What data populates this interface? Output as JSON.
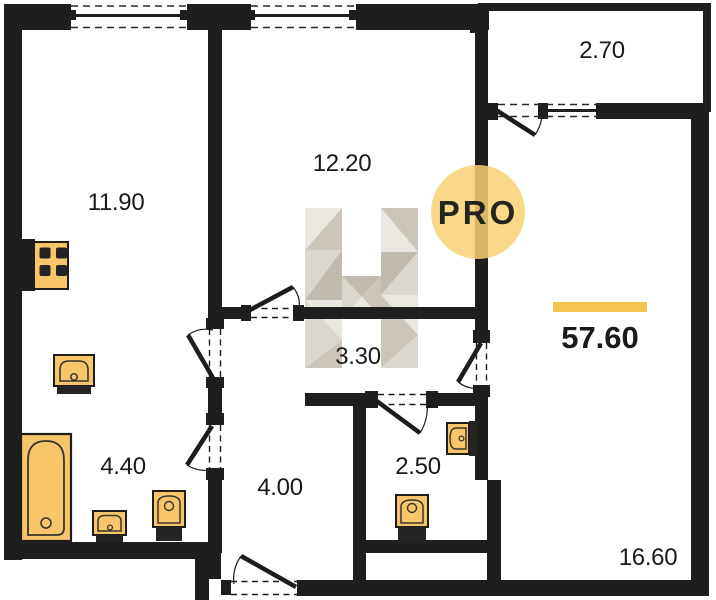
{
  "plan": {
    "type": "apartment-floor-plan",
    "total_area": "57.60",
    "rooms": [
      {
        "name": "room-left",
        "area": "11.90"
      },
      {
        "name": "room-middle",
        "area": "12.20"
      },
      {
        "name": "balcony",
        "area": "2.70"
      },
      {
        "name": "hallway",
        "area": "3.30"
      },
      {
        "name": "bathroom",
        "area": "4.40"
      },
      {
        "name": "hall",
        "area": "4.00"
      },
      {
        "name": "wc",
        "area": "2.50"
      },
      {
        "name": "room-right",
        "area": "16.60"
      }
    ],
    "watermark": {
      "badge_text": "PRO",
      "logo": "H-faceted-logo"
    },
    "fixture_icons": [
      "stove-icon",
      "kitchen-sink-icon",
      "bathtub-icon",
      "washbasin-icon",
      "toilet-icon",
      "toilet-icon",
      "wall-sink-icon"
    ],
    "colors": {
      "wall": "#1e1e1e",
      "floor": "#ffffff",
      "fixture_fill": "#f7c66b",
      "fixture_dark": "#262422",
      "accent_bar": "#f2c54f",
      "pro_badge_fill": "#f8d173",
      "pro_badge_text": "#97918a",
      "logo_greys": [
        "#eae7e1",
        "#dcd7ce",
        "#ccc5ba",
        "#c1baae"
      ]
    }
  }
}
